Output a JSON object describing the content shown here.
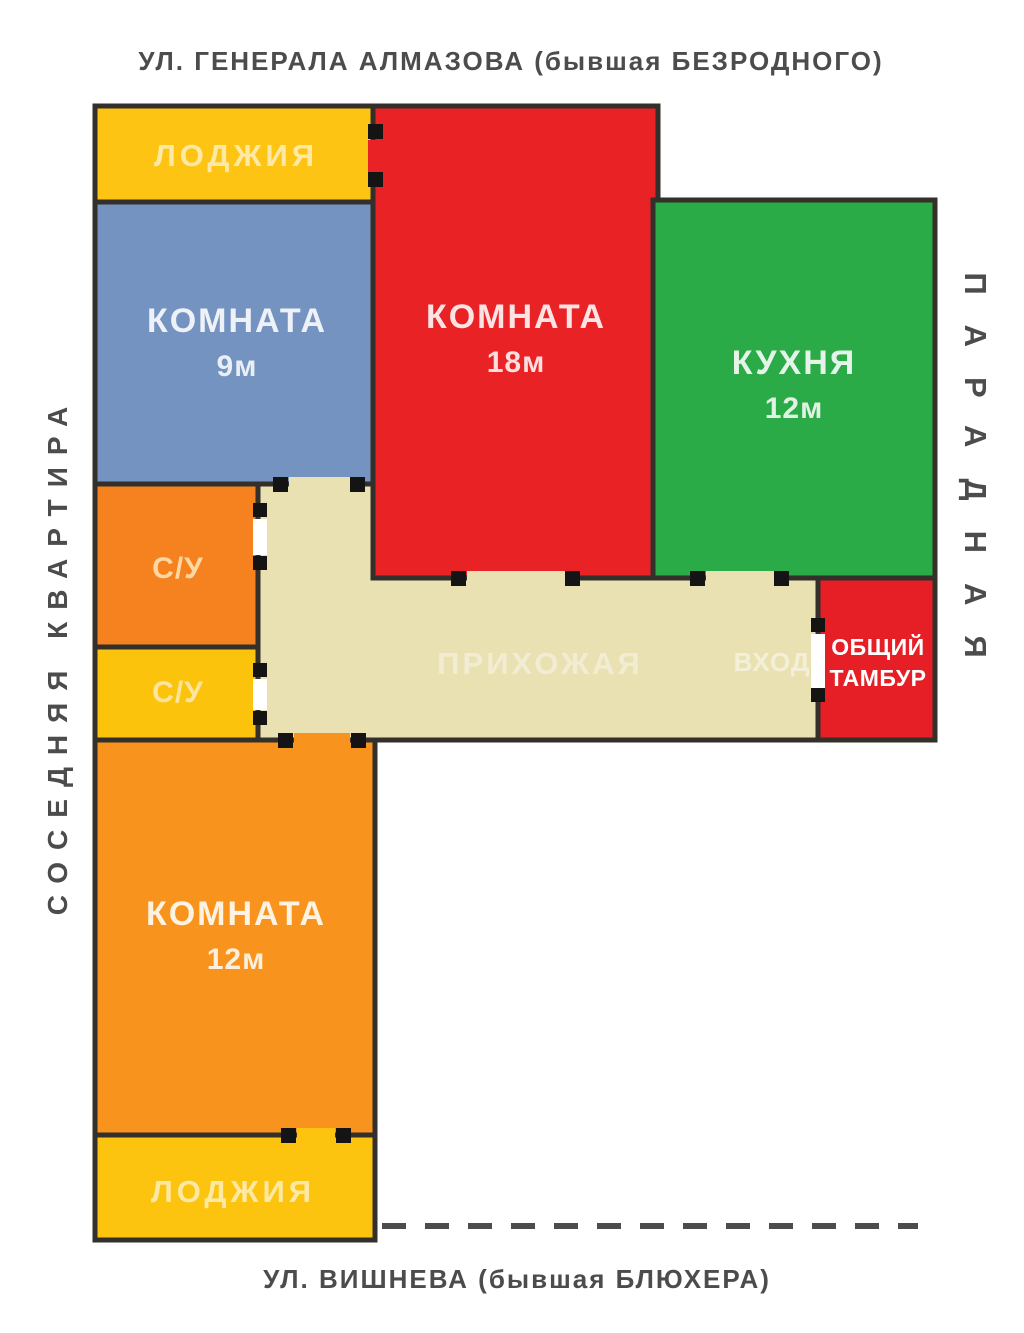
{
  "streets": {
    "top": "УЛ. ГЕНЕРАЛА АЛМАЗОВА (бывшая БЕЗРОДНОГО)",
    "bottom": "УЛ. ВИШНЕВА (бывшая БЛЮХЕРА)"
  },
  "sides": {
    "left": "СОСЕДНЯЯ КВАРТИРА",
    "right": "ПАРАДНАЯ"
  },
  "rooms": {
    "loggia_top": {
      "label": "ЛОДЖИЯ",
      "color": "#fdc413"
    },
    "room9": {
      "label": "КОМНАТА",
      "area": "9м",
      "color": "#7493c0"
    },
    "room18": {
      "label": "КОМНАТА",
      "area": "18м",
      "color": "#e92226"
    },
    "kitchen": {
      "label": "КУХНЯ",
      "area": "12м",
      "color": "#2bab47"
    },
    "su_upper": {
      "label": "С/У",
      "color": "#f5821f"
    },
    "su_lower": {
      "label": "С/У",
      "color": "#fcc30d"
    },
    "hallway": {
      "label": "ПРИХОЖАЯ",
      "color": "#e9e1b2"
    },
    "entrance": {
      "label": "ВХОД"
    },
    "tambur": {
      "line1": "ОБЩИЙ",
      "line2": "ТАМБУР",
      "color": "#e51f25"
    },
    "room12": {
      "label": "КОМНАТА",
      "area": "12м",
      "color": "#f8941e"
    },
    "loggia_bottom": {
      "label": "ЛОДЖИЯ",
      "color": "#fcc30f"
    }
  },
  "colors": {
    "wall": "#332f2a",
    "door_tick": "#141414",
    "street_text": "#4c4c4c"
  }
}
